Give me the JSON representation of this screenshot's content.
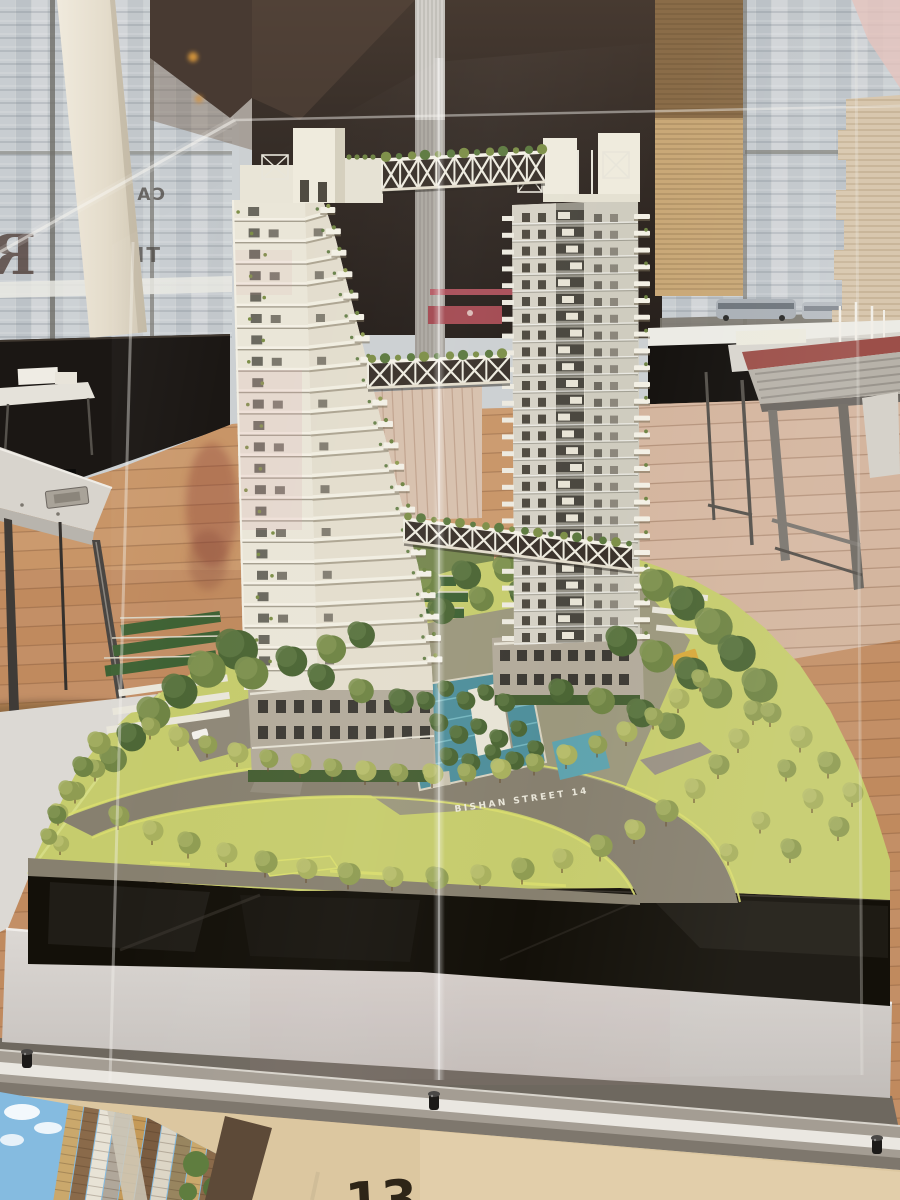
{
  "scene": {
    "description": "Architectural scale model of twin residential towers linked by truss sky-bridges, displayed in a glass case in a showroom gallery with wooden floor, metal display tables and street-facing windows"
  },
  "labels": {
    "street_name": "BISHAN STREET 14",
    "glass_sign_top": "CA",
    "glass_sign_mid": "TE",
    "glass_sign_big": "R",
    "placard_digits": "13"
  },
  "palette": {
    "wall_brown": "#372e28",
    "wall_brown_light": "#5b4a3e",
    "wood_floor": "#c08a5e",
    "wood_floor_light": "#d8c0b0",
    "lawn": "#c6cc6d",
    "lawn_edge": "#d9dd6e",
    "road": "#87806f",
    "pool": "#4f8f9b",
    "tower_white": "#eae6d8",
    "tower_shadow_face": "#b8b5aa",
    "window_dark": "#4f4a40",
    "plinth_black": "#121008",
    "pedestal": "#d5d1cd",
    "rail_metal": "#a49d93",
    "rail_highlight": "#f2f0ea",
    "blind_tan": "#c9a877",
    "accent_red_bar": "#a34a52",
    "photo_sky": "#85bbe0",
    "plant_green": "#7d8f48",
    "tree_dark": "#4c6635"
  },
  "model": {
    "left_tower": {
      "floor_count": 23,
      "floor_top_y": 205,
      "floor_bottom_y": 688,
      "floor_step": 21.4,
      "edge_profile": [
        [
          200,
          323
        ],
        [
          250,
          336
        ],
        [
          300,
          350
        ],
        [
          350,
          363
        ],
        [
          400,
          377
        ],
        [
          450,
          390
        ],
        [
          500,
          403
        ],
        [
          540,
          413
        ],
        [
          575,
          422
        ],
        [
          610,
          428
        ],
        [
          645,
          431
        ],
        [
          690,
          433
        ]
      ]
    },
    "right_tower": {
      "floor_count": 26,
      "floor_top_y": 210,
      "floor_bottom_y": 645,
      "floor_step": 16.8,
      "x_left": 512,
      "x_right": 638
    },
    "bridges": [
      {
        "x1": 382,
        "y1": 160,
        "x2": 545,
        "y2": 152,
        "h": 30,
        "segments": 9
      },
      {
        "x1": 368,
        "y1": 362,
        "x2": 510,
        "y2": 356,
        "h": 26,
        "segments": 6
      },
      {
        "x1": 404,
        "y1": 519,
        "x2": 632,
        "y2": 547,
        "h": 23,
        "segments": 10
      }
    ]
  },
  "trees": {
    "shade_colors": [
      "#8f9c52",
      "#6f8444",
      "#4c6635",
      "#a8b05e"
    ],
    "shade_tops": [
      "#a3ae62",
      "#819452",
      "#5d7742",
      "#b8bf6e"
    ],
    "north_row": [
      [
        150,
        726,
        9,
        0
      ],
      [
        178,
        736,
        10,
        3
      ],
      [
        207,
        744,
        9,
        0
      ],
      [
        237,
        752,
        10,
        3
      ],
      [
        268,
        758,
        9,
        0
      ],
      [
        300,
        763,
        10,
        3
      ],
      [
        332,
        767,
        9,
        0
      ],
      [
        365,
        770,
        10,
        3
      ],
      [
        398,
        772,
        9,
        0
      ],
      [
        432,
        773,
        10,
        3
      ],
      [
        466,
        772,
        9,
        0
      ],
      [
        500,
        768,
        10,
        3
      ],
      [
        534,
        762,
        9,
        0
      ],
      [
        566,
        754,
        10,
        3
      ],
      [
        597,
        744,
        9,
        0
      ],
      [
        626,
        731,
        10,
        3
      ],
      [
        653,
        716,
        9,
        0
      ],
      [
        678,
        698,
        10,
        3
      ],
      [
        700,
        678,
        9,
        0
      ]
    ],
    "south_row": [
      [
        118,
        815,
        10,
        0
      ],
      [
        152,
        830,
        10,
        3
      ],
      [
        188,
        842,
        11,
        0
      ],
      [
        226,
        852,
        10,
        3
      ],
      [
        265,
        861,
        11,
        0
      ],
      [
        306,
        868,
        10,
        3
      ],
      [
        348,
        873,
        11,
        0
      ],
      [
        392,
        876,
        10,
        3
      ],
      [
        436,
        877,
        11,
        0
      ],
      [
        480,
        874,
        10,
        3
      ],
      [
        522,
        868,
        11,
        0
      ],
      [
        562,
        858,
        10,
        3
      ],
      [
        600,
        845,
        11,
        0
      ],
      [
        634,
        829,
        10,
        3
      ],
      [
        666,
        810,
        11,
        0
      ],
      [
        694,
        788,
        10,
        3
      ],
      [
        718,
        764,
        10,
        0
      ],
      [
        738,
        738,
        10,
        3
      ],
      [
        753,
        710,
        10,
        0
      ],
      [
        75,
        790,
        9,
        0
      ],
      [
        58,
        812,
        9,
        3
      ],
      [
        95,
        768,
        9,
        0
      ],
      [
        60,
        843,
        8,
        3
      ]
    ],
    "clusters_back": [
      [
        345,
        604,
        16,
        1
      ],
      [
        385,
        592,
        15,
        2
      ],
      [
        425,
        582,
        14,
        1
      ],
      [
        465,
        574,
        14,
        2
      ],
      [
        505,
        568,
        13,
        1
      ],
      [
        545,
        563,
        13,
        2
      ],
      [
        585,
        562,
        14,
        1
      ],
      [
        620,
        570,
        15,
        2
      ],
      [
        560,
        600,
        12,
        1
      ],
      [
        520,
        592,
        12,
        2
      ],
      [
        480,
        598,
        12,
        1
      ],
      [
        440,
        610,
        13,
        2
      ],
      [
        400,
        622,
        13,
        1
      ],
      [
        600,
        615,
        13,
        2
      ],
      [
        305,
        618,
        16,
        1
      ],
      [
        270,
        632,
        17,
        2
      ]
    ],
    "clusters_front": [
      [
        235,
        648,
        20,
        2
      ],
      [
        205,
        668,
        18,
        1
      ],
      [
        178,
        690,
        17,
        2
      ],
      [
        152,
        712,
        16,
        1
      ],
      [
        130,
        736,
        14,
        2
      ],
      [
        112,
        758,
        13,
        1
      ],
      [
        250,
        672,
        16,
        1
      ],
      [
        290,
        660,
        15,
        2
      ],
      [
        330,
        648,
        14,
        1
      ],
      [
        320,
        676,
        13,
        2
      ],
      [
        360,
        690,
        12,
        1
      ],
      [
        400,
        700,
        12,
        2
      ],
      [
        655,
        584,
        16,
        1
      ],
      [
        685,
        602,
        17,
        2
      ],
      [
        712,
        625,
        18,
        1
      ],
      [
        735,
        652,
        18,
        2
      ],
      [
        758,
        684,
        17,
        1
      ],
      [
        620,
        640,
        15,
        2
      ],
      [
        655,
        655,
        16,
        1
      ],
      [
        690,
        672,
        16,
        2
      ],
      [
        715,
        692,
        15,
        1
      ],
      [
        640,
        712,
        14,
        2
      ],
      [
        670,
        725,
        13,
        1
      ],
      [
        560,
        690,
        12,
        2
      ],
      [
        600,
        700,
        13,
        1
      ],
      [
        360,
        634,
        13,
        2
      ]
    ],
    "court": [
      [
        425,
        700,
        9,
        2
      ],
      [
        445,
        688,
        8,
        2
      ],
      [
        465,
        700,
        9,
        2
      ],
      [
        485,
        692,
        8,
        2
      ],
      [
        505,
        702,
        9,
        2
      ],
      [
        438,
        722,
        9,
        2
      ],
      [
        458,
        734,
        9,
        2
      ],
      [
        478,
        726,
        8,
        2
      ],
      [
        498,
        738,
        9,
        2
      ],
      [
        518,
        728,
        8,
        2
      ],
      [
        448,
        756,
        9,
        2
      ],
      [
        470,
        762,
        9,
        2
      ],
      [
        492,
        752,
        8,
        2
      ],
      [
        514,
        760,
        9,
        2
      ],
      [
        535,
        748,
        8,
        2
      ]
    ],
    "right_lawn": [
      [
        770,
        712,
        10,
        0
      ],
      [
        800,
        736,
        11,
        3
      ],
      [
        828,
        762,
        11,
        0
      ],
      [
        852,
        792,
        10,
        3
      ],
      [
        786,
        768,
        9,
        0
      ],
      [
        812,
        798,
        10,
        3
      ],
      [
        838,
        826,
        10,
        0
      ],
      [
        760,
        820,
        9,
        3
      ],
      [
        790,
        848,
        10,
        0
      ],
      [
        728,
        852,
        9,
        3
      ]
    ],
    "left_shrubs": [
      [
        98,
        742,
        11,
        0
      ],
      [
        82,
        766,
        10,
        1
      ],
      [
        68,
        790,
        10,
        0
      ],
      [
        56,
        814,
        9,
        1
      ],
      [
        48,
        836,
        8,
        0
      ]
    ]
  },
  "floor_planks": {
    "spacing": 19,
    "drop": 42,
    "line_color": "rgba(110,70,42,0.30)"
  },
  "rail_knobs": [
    [
      27,
      1060
    ],
    [
      434,
      1102
    ],
    [
      877,
      1146
    ]
  ]
}
